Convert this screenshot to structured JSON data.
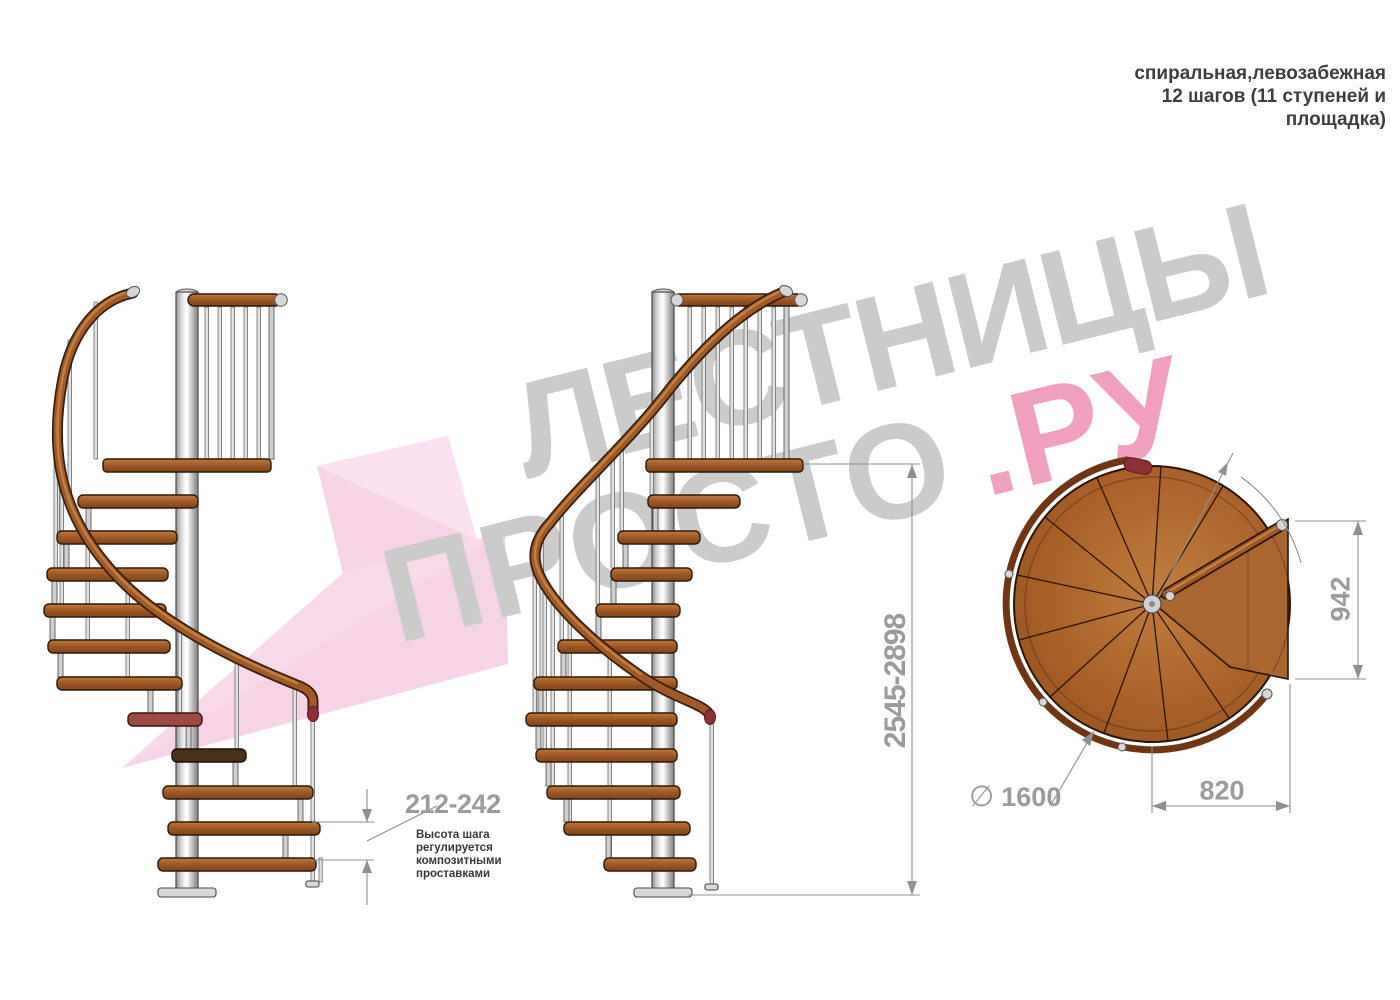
{
  "header": {
    "lines": [
      "спиральная,левозабежная",
      "12 шагов (11 ступеней и",
      "площадка)"
    ]
  },
  "watermark": {
    "word1": "ЛЕСТНИЦЫ",
    "word2": "ПРОСТО",
    "word3": ".РУ"
  },
  "dimensions": {
    "step_height_range": "212-242",
    "step_height_note": [
      "Высота шага",
      "регулируется",
      "композитными",
      "проставками"
    ],
    "total_height_range": "2545-2898",
    "landing_depth": "942",
    "landing_width": "820",
    "diameter_symbol": "∅",
    "diameter_value": "1600"
  },
  "colors": {
    "wood": "#a55d28",
    "wood-dark": "#2e1808",
    "wood-light": "#c17a3c",
    "dim": "#8f8f8f",
    "dim-text": "#9b9b9b",
    "ink": "#3e3e3e",
    "wm-gray": "#cbcbcb",
    "wm-pink": "#f19fbe",
    "arrow-pink": "#f7d3e6",
    "maroon": "#8c2f39"
  }
}
